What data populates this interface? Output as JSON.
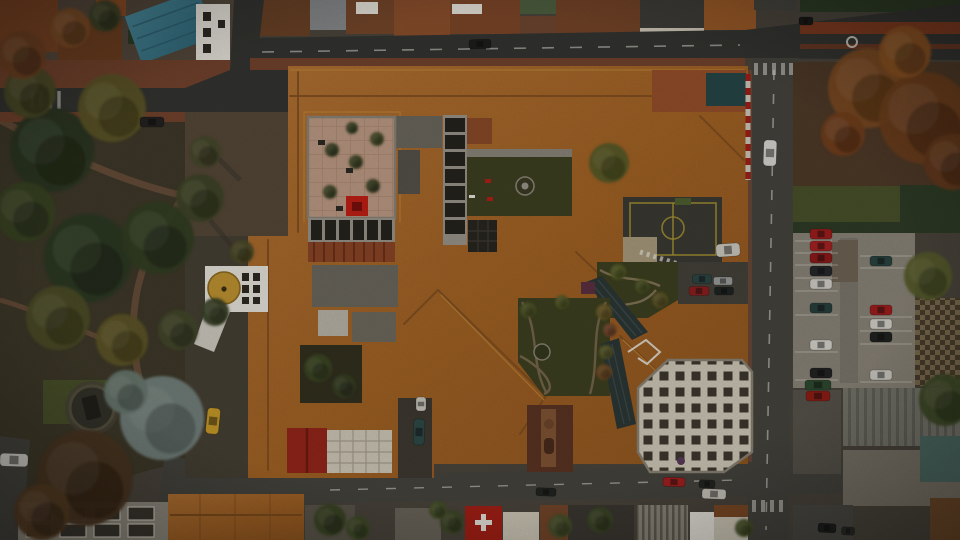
{
  "scene": {
    "type": "aerial-photograph",
    "subject": "Top-down drone view of a historic monastery / convent block with terracotta tiled roofs, inner courtyards and gardens, a white bell tower with a golden dome, surrounded by streets, a tree-filled park, parking lots and neighbouring buildings",
    "orientation": "nadir (straight down)",
    "lighting": "overcast, muted daylight"
  },
  "palette": {
    "asphalt": "#45443e",
    "asphaltDark": "#343431",
    "asphaltLight": "#55544c",
    "roofTile": "#a96a2c",
    "roofTileDark": "#7e4c1e",
    "roofTileLight": "#c08a3a",
    "brick": "#73432d",
    "brickLight": "#8a4f36",
    "parkGround": "#3e3929",
    "lawnDark": "#3d4020",
    "lawnLight": "#49512a",
    "courtPave": "#bd9a85",
    "paveLine": "#a9866f",
    "white": "#e6e3da",
    "cream": "#cfc8b8",
    "cofferDark": "#3e382e",
    "tealRoof": "#3d7b8c",
    "tealDark": "#2c5f6e",
    "gold": "#bf9331",
    "goldDark": "#8a6a1e",
    "redAccent": "#c02014",
    "redRoof": "#94261a",
    "swissRed": "#a32016",
    "slateGlass": "#2c3736",
    "concrete": "#8f8a7e",
    "metalGray": "#6e6e64",
    "courtDark": "#3b3a33",
    "courtYellow": "#ac9832",
    "hedge": "#2e3c26",
    "dirt": "#5e4434",
    "sportTeal": "#274646",
    "stone": "#6b675c",
    "parkingGray": "#8a8478"
  },
  "landmarks": [
    {
      "id": "bell-tower",
      "label": "white bell tower with golden dome"
    },
    {
      "id": "cloister-courtyard",
      "label": "stone-paved cloister courtyard with small trees and red cube sculpture"
    },
    {
      "id": "lawn-courtyard",
      "label": "lawn courtyard with circular fountain and red benches"
    },
    {
      "id": "winding-garden",
      "label": "terraced gardens with winding paths and pond"
    },
    {
      "id": "coffered-roof",
      "label": "white coffered grid rooftop"
    },
    {
      "id": "sports-court",
      "label": "rooftop sports court with yellow markings"
    },
    {
      "id": "city-park",
      "label": "tree-filled park with circular monument"
    },
    {
      "id": "teal-roof-building",
      "label": "building with teal metal gable roof"
    },
    {
      "id": "swiss-cross-roof",
      "label": "red roof with white cross"
    },
    {
      "id": "right-parking-lot",
      "label": "parking lot with two rows of parked cars"
    }
  ],
  "vehicles": [
    {
      "type": "car",
      "color": "#1e1e1c",
      "x": 480,
      "y": 44,
      "w": 22,
      "h": 9,
      "a": -2
    },
    {
      "type": "car",
      "color": "#232220",
      "x": 152,
      "y": 122,
      "w": 24,
      "h": 10,
      "a": 0
    },
    {
      "type": "car",
      "color": "#d8d7d2",
      "x": 770,
      "y": 153,
      "w": 13,
      "h": 26,
      "a": 2
    },
    {
      "type": "car",
      "color": "#1a1a18",
      "x": 806,
      "y": 21,
      "w": 14,
      "h": 8,
      "a": 0
    },
    {
      "type": "taxi",
      "color": "#c79a28",
      "x": 213,
      "y": 421,
      "w": 13,
      "h": 26,
      "a": 6
    },
    {
      "type": "truck",
      "color": "#d0cdc5",
      "x": 14,
      "y": 460,
      "w": 28,
      "h": 13,
      "a": 2
    },
    {
      "type": "van",
      "color": "#c9c6bc",
      "x": 421,
      "y": 404,
      "w": 10,
      "h": 14,
      "a": 0
    },
    {
      "type": "car",
      "color": "#2e4a48",
      "x": 419,
      "y": 432,
      "w": 11,
      "h": 26,
      "a": 2
    },
    {
      "type": "car",
      "color": "#2c4644",
      "x": 702,
      "y": 279,
      "w": 19,
      "h": 9,
      "a": 0
    },
    {
      "type": "car",
      "color": "#9a9c9a",
      "x": 723,
      "y": 281,
      "w": 19,
      "h": 8,
      "a": 0
    },
    {
      "type": "car",
      "color": "#8c1f1f",
      "x": 699,
      "y": 291,
      "w": 20,
      "h": 9,
      "a": 0
    },
    {
      "type": "car",
      "color": "#1f2422",
      "x": 724,
      "y": 291,
      "w": 19,
      "h": 8,
      "a": 0
    },
    {
      "type": "van",
      "color": "#ccc9bf",
      "x": 728,
      "y": 250,
      "w": 24,
      "h": 13,
      "a": -4
    },
    {
      "type": "car",
      "color": "#a32020",
      "x": 674,
      "y": 482,
      "w": 22,
      "h": 9,
      "a": 2
    },
    {
      "type": "van",
      "color": "#242623",
      "x": 707,
      "y": 484,
      "w": 16,
      "h": 8,
      "a": 2
    },
    {
      "type": "truck",
      "color": "#c9c6bc",
      "x": 714,
      "y": 494,
      "w": 24,
      "h": 10,
      "a": 2
    },
    {
      "type": "car",
      "color": "#232522",
      "x": 546,
      "y": 492,
      "w": 20,
      "h": 8,
      "a": 2
    },
    {
      "type": "car",
      "color": "#1e201e",
      "x": 827,
      "y": 528,
      "w": 18,
      "h": 9,
      "a": 3
    },
    {
      "type": "car",
      "color": "#2a2c28",
      "x": 848,
      "y": 531,
      "w": 13,
      "h": 8,
      "a": 3
    },
    {
      "type": "car",
      "color": "#9e1e1c",
      "x": 821,
      "y": 234,
      "w": 22,
      "h": 10,
      "a": 0
    },
    {
      "type": "car",
      "color": "#a82222",
      "x": 821,
      "y": 246,
      "w": 22,
      "h": 10,
      "a": 0
    },
    {
      "type": "car",
      "color": "#8e1a1a",
      "x": 821,
      "y": 258,
      "w": 22,
      "h": 10,
      "a": 0
    },
    {
      "type": "car",
      "color": "#26282a",
      "x": 821,
      "y": 271,
      "w": 22,
      "h": 10,
      "a": 0
    },
    {
      "type": "car",
      "color": "#d2d0c8",
      "x": 821,
      "y": 284,
      "w": 22,
      "h": 10,
      "a": 0
    },
    {
      "type": "car",
      "color": "#28403c",
      "x": 821,
      "y": 308,
      "w": 22,
      "h": 10,
      "a": 0
    },
    {
      "type": "car",
      "color": "#d6d4cc",
      "x": 821,
      "y": 345,
      "w": 22,
      "h": 10,
      "a": 0
    },
    {
      "type": "car",
      "color": "#222422",
      "x": 821,
      "y": 373,
      "w": 22,
      "h": 10,
      "a": 0
    },
    {
      "type": "car",
      "color": "#2a4440",
      "x": 881,
      "y": 261,
      "w": 22,
      "h": 10,
      "a": 0
    },
    {
      "type": "car",
      "color": "#a01e1e",
      "x": 881,
      "y": 310,
      "w": 22,
      "h": 10,
      "a": 0
    },
    {
      "type": "car",
      "color": "#d4d2ca",
      "x": 881,
      "y": 324,
      "w": 22,
      "h": 10,
      "a": 0
    },
    {
      "type": "car",
      "color": "#1f2220",
      "x": 881,
      "y": 337,
      "w": 22,
      "h": 10,
      "a": 0
    },
    {
      "type": "car",
      "color": "#d0cec6",
      "x": 881,
      "y": 375,
      "w": 22,
      "h": 10,
      "a": 0
    },
    {
      "type": "dumpster",
      "color": "#2e4a30",
      "x": 818,
      "y": 385,
      "w": 26,
      "h": 10,
      "a": 0
    },
    {
      "type": "dumpster",
      "color": "#8e1e16",
      "x": 818,
      "y": 396,
      "w": 24,
      "h": 10,
      "a": 0
    }
  ],
  "trees": [
    {
      "x": 52,
      "y": 150,
      "r": 42,
      "color": "#2b3720"
    },
    {
      "x": 112,
      "y": 108,
      "r": 34,
      "color": "#5c5526"
    },
    {
      "x": 30,
      "y": 92,
      "r": 26,
      "color": "#4a4a26"
    },
    {
      "x": 25,
      "y": 212,
      "r": 30,
      "color": "#3a4424"
    },
    {
      "x": 88,
      "y": 258,
      "r": 44,
      "color": "#2c3a22"
    },
    {
      "x": 158,
      "y": 238,
      "r": 36,
      "color": "#323e24"
    },
    {
      "x": 200,
      "y": 198,
      "r": 24,
      "color": "#3e4526"
    },
    {
      "x": 58,
      "y": 318,
      "r": 32,
      "color": "#4c4c28"
    },
    {
      "x": 122,
      "y": 340,
      "r": 26,
      "color": "#5e5428"
    },
    {
      "x": 22,
      "y": 55,
      "r": 24,
      "color": "#6e4222"
    },
    {
      "x": 70,
      "y": 28,
      "r": 20,
      "color": "#7c4c26"
    },
    {
      "x": 105,
      "y": 16,
      "r": 16,
      "color": "#3c4226"
    },
    {
      "x": 178,
      "y": 330,
      "r": 20,
      "color": "#44482a"
    },
    {
      "x": 162,
      "y": 418,
      "r": 42,
      "color": "#75827e"
    },
    {
      "x": 126,
      "y": 392,
      "r": 22,
      "color": "#68786f"
    },
    {
      "x": 85,
      "y": 478,
      "r": 48,
      "color": "#4a3520"
    },
    {
      "x": 42,
      "y": 512,
      "r": 28,
      "color": "#543c24"
    },
    {
      "x": 215,
      "y": 312,
      "r": 14,
      "color": "#3a4226"
    },
    {
      "x": 242,
      "y": 252,
      "r": 12,
      "color": "#4c4a28"
    },
    {
      "x": 205,
      "y": 152,
      "r": 16,
      "color": "#46482a"
    },
    {
      "x": 609,
      "y": 163,
      "r": 20,
      "color": "#565a28"
    },
    {
      "x": 332,
      "y": 150,
      "r": 7,
      "color": "#3a4224"
    },
    {
      "x": 356,
      "y": 162,
      "r": 7,
      "color": "#3c4424"
    },
    {
      "x": 373,
      "y": 186,
      "r": 7,
      "color": "#384022"
    },
    {
      "x": 330,
      "y": 192,
      "r": 7,
      "color": "#404626"
    },
    {
      "x": 352,
      "y": 128,
      "r": 6,
      "color": "#3a4224"
    },
    {
      "x": 377,
      "y": 139,
      "r": 7,
      "color": "#444a26"
    },
    {
      "x": 318,
      "y": 368,
      "r": 14,
      "color": "#3c4624"
    },
    {
      "x": 344,
      "y": 386,
      "r": 12,
      "color": "#364024"
    },
    {
      "x": 604,
      "y": 312,
      "r": 8,
      "color": "#6a5a28"
    },
    {
      "x": 610,
      "y": 330,
      "r": 7,
      "color": "#74462a"
    },
    {
      "x": 606,
      "y": 352,
      "r": 7,
      "color": "#5c5c2a"
    },
    {
      "x": 604,
      "y": 372,
      "r": 8,
      "color": "#6e4a24"
    },
    {
      "x": 528,
      "y": 310,
      "r": 8,
      "color": "#4e5426"
    },
    {
      "x": 562,
      "y": 302,
      "r": 7,
      "color": "#525828"
    },
    {
      "x": 618,
      "y": 272,
      "r": 8,
      "color": "#565c28"
    },
    {
      "x": 642,
      "y": 286,
      "r": 7,
      "color": "#4e5426"
    },
    {
      "x": 660,
      "y": 300,
      "r": 8,
      "color": "#5e5428"
    },
    {
      "x": 868,
      "y": 88,
      "r": 40,
      "color": "#7c4a20"
    },
    {
      "x": 925,
      "y": 118,
      "r": 46,
      "color": "#6e3f1c"
    },
    {
      "x": 905,
      "y": 52,
      "r": 26,
      "color": "#8a5222"
    },
    {
      "x": 952,
      "y": 162,
      "r": 28,
      "color": "#64391c"
    },
    {
      "x": 843,
      "y": 134,
      "r": 22,
      "color": "#713f1e"
    },
    {
      "x": 928,
      "y": 276,
      "r": 24,
      "color": "#565c2a"
    },
    {
      "x": 945,
      "y": 400,
      "r": 26,
      "color": "#3f4a26"
    },
    {
      "x": 330,
      "y": 520,
      "r": 16,
      "color": "#3a4424"
    },
    {
      "x": 358,
      "y": 528,
      "r": 12,
      "color": "#404a26"
    },
    {
      "x": 452,
      "y": 522,
      "r": 12,
      "color": "#3e4826"
    },
    {
      "x": 560,
      "y": 526,
      "r": 12,
      "color": "#46502a"
    },
    {
      "x": 600,
      "y": 520,
      "r": 13,
      "color": "#3c4626"
    },
    {
      "x": 438,
      "y": 510,
      "r": 9,
      "color": "#444e28"
    },
    {
      "x": 744,
      "y": 528,
      "r": 9,
      "color": "#465028"
    }
  ]
}
